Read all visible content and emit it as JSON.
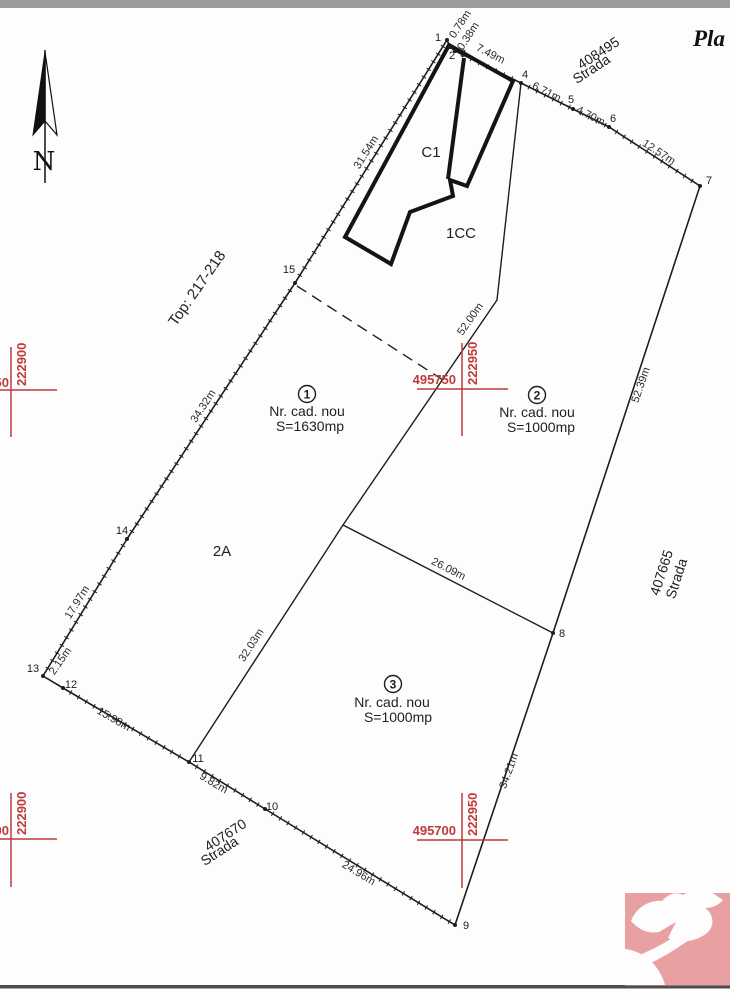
{
  "page": {
    "title_partial": "Pla"
  },
  "compass": {
    "label": "N"
  },
  "streets": {
    "top": {
      "number": "408495",
      "name": "Strada"
    },
    "right": {
      "number": "407665",
      "name": "Strada"
    },
    "bottom": {
      "number": "407670",
      "name": "Strada"
    }
  },
  "area_labels": {
    "top_ref": "Top: 217-218",
    "zone": "2A",
    "building": "C1",
    "courtyard": "1CC"
  },
  "parcels": [
    {
      "number": "1",
      "line1": "Nr. cad. nou",
      "line2": "S=1630mp"
    },
    {
      "number": "2",
      "line1": "Nr. cad. nou",
      "line2": "S=1000mp"
    },
    {
      "number": "3",
      "line1": "Nr. cad. nou",
      "line2": "S=1000mp"
    }
  ],
  "dimensions": {
    "d_0_78": "0.78m",
    "d_0_38": "0.38m",
    "d_7_49": "7.49m",
    "d_6_71": "6.71m",
    "d_4_70": "4.70m",
    "d_12_57": "12.57m",
    "d_31_54": "31.54m",
    "d_34_32": "34.32m",
    "d_17_97": "17.97m",
    "d_2_15": "2.15m",
    "d_15_98": "15.98m",
    "d_9_82": "9.82m",
    "d_24_96": "24.96m",
    "d_34_21": "34.21m",
    "d_52_39": "52.39m",
    "d_52_00": "52.00m",
    "d_26_09": "26.09m",
    "d_32_03": "32.03m"
  },
  "points": {
    "p1": "1",
    "p2": "2",
    "p3": "3",
    "p4": "4",
    "p5": "5",
    "p6": "6",
    "p7": "7",
    "p8": "8",
    "p9": "9",
    "p10": "10",
    "p11": "11",
    "p12": "12",
    "p13": "13",
    "p14": "14",
    "p15": "15"
  },
  "grid": {
    "mid_upper": {
      "x": "495750",
      "y": "222950"
    },
    "mid_lower": {
      "x": "495700",
      "y": "222950"
    },
    "left_upper": {
      "x_cut": "50",
      "y": "222900"
    },
    "left_lower": {
      "x_cut": "00",
      "y": "222900"
    }
  },
  "icons": {
    "compass": "north-arrow",
    "logo": "dove-bird"
  },
  "colors": {
    "red": "#c03a3a",
    "ink": "#1d1d1d",
    "logo_pink": "#e8a0a2",
    "top_bar": "#9b9b9b",
    "bottom_rule": "#4e4e4e"
  }
}
